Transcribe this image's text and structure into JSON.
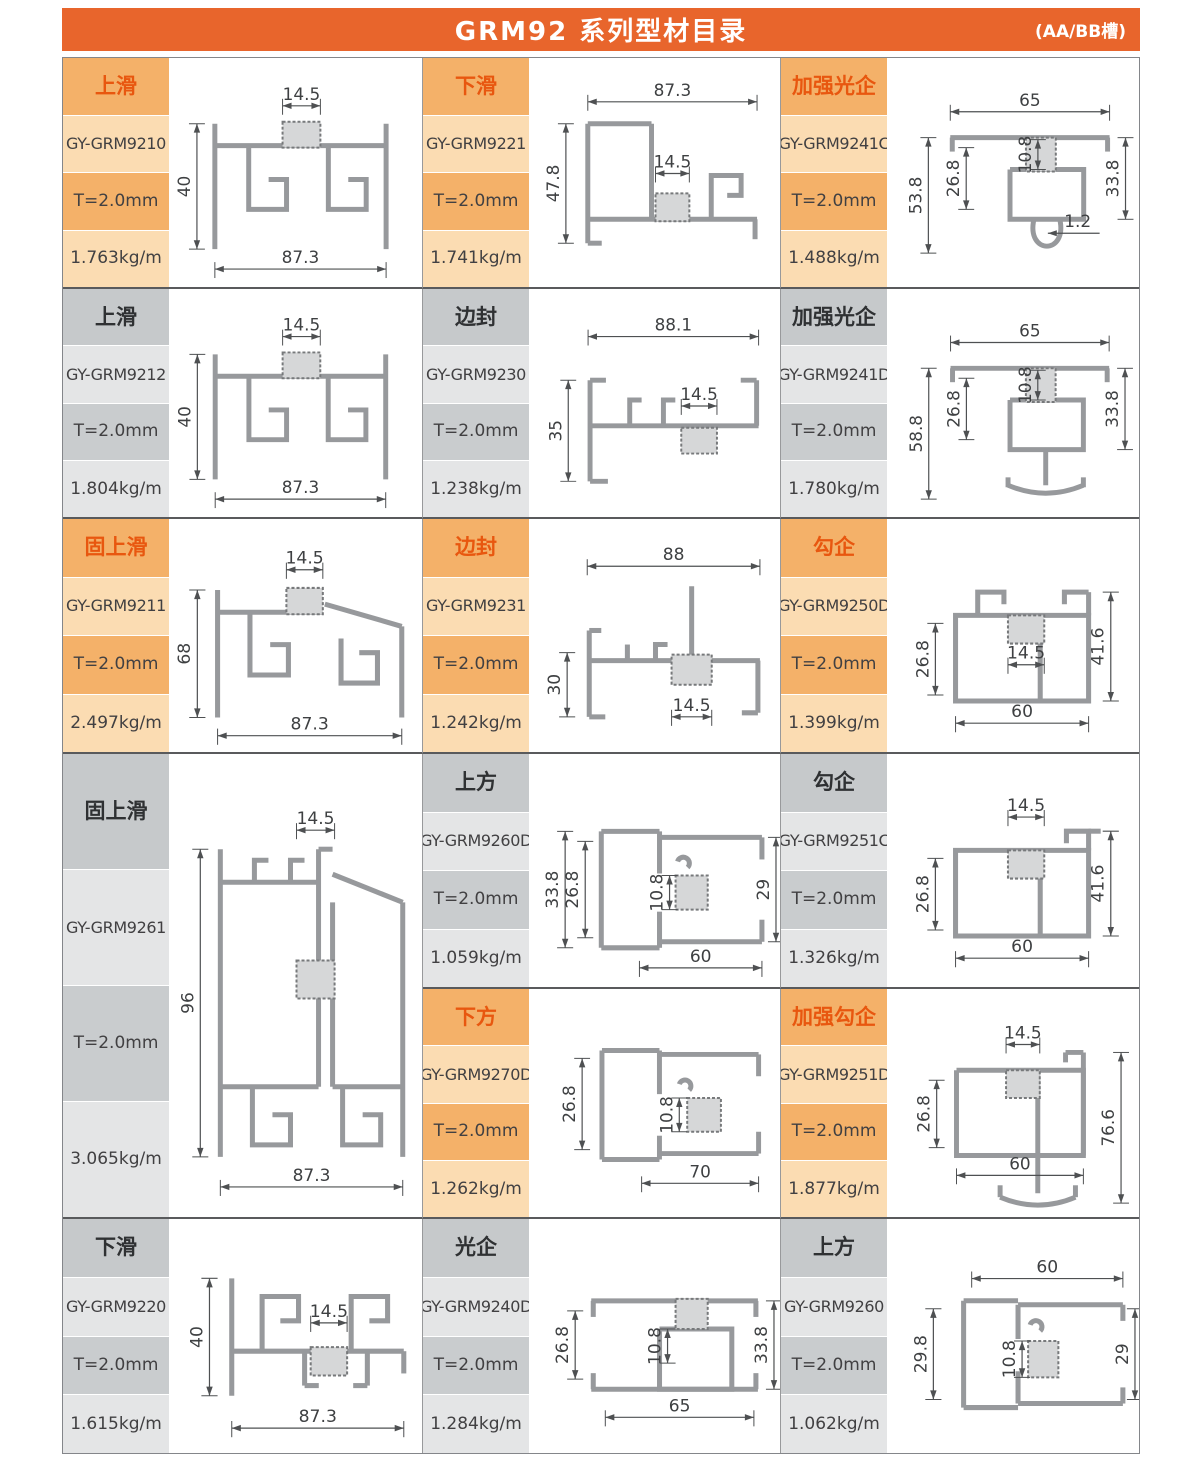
{
  "header": {
    "title": "GRM92 系列型材目录",
    "note": "(AA/BB槽)"
  },
  "theme": {
    "header_bg": "#E8652C",
    "orange_box": "#F4B169",
    "orange_box_light": "#FBDCB2",
    "orange_text": "#E8570F",
    "gray_box": "#C6C9CB",
    "gray_box_light": "#E4E5E6",
    "text_dark": "#414042",
    "line_dark": "#595A5C",
    "profile_gray": "#97999C"
  },
  "cells": [
    {
      "type_label": "上滑",
      "model": "GY-GRM9210",
      "thickness": "T=2.0mm",
      "weight": "1.763kg/m",
      "shape": "t_slide",
      "dims": {
        "top": "14.5",
        "left": "40",
        "bottom": "87.3"
      }
    },
    {
      "type_label": "下滑",
      "model": "GY-GRM9221",
      "thickness": "T=2.0mm",
      "weight": "1.741kg/m",
      "shape": "d_slide21",
      "dims": {
        "top": "87.3",
        "left": "47.8",
        "mid": "14.5"
      }
    },
    {
      "type_label": "加强光企",
      "model": "GY-GRM9241C",
      "thickness": "T=2.0mm",
      "weight": "1.488kg/m",
      "shape": "s_guang_c",
      "dims": {
        "top": "65",
        "left": "53.8",
        "inner": "26.8",
        "core": "10.8",
        "right": "33.8",
        "small": "1.2"
      }
    },
    {
      "type_label": "上滑",
      "model": "GY-GRM9212",
      "thickness": "T=2.0mm",
      "weight": "1.804kg/m",
      "shape": "t_slide",
      "dims": {
        "top": "14.5",
        "left": "40",
        "bottom": "87.3"
      }
    },
    {
      "type_label": "边封",
      "model": "GY-GRM9230",
      "thickness": "T=2.0mm",
      "weight": "1.238kg/m",
      "shape": "bianfeng30",
      "dims": {
        "top": "88.1",
        "left": "35",
        "mid": "14.5"
      }
    },
    {
      "type_label": "加强光企",
      "model": "GY-GRM9241D",
      "thickness": "T=2.0mm",
      "weight": "1.780kg/m",
      "shape": "s_guang_d",
      "dims": {
        "top": "65",
        "left": "58.8",
        "inner": "26.8",
        "core": "10.8",
        "right": "33.8"
      }
    },
    {
      "type_label": "固上滑",
      "model": "GY-GRM9211",
      "thickness": "T=2.0mm",
      "weight": "2.497kg/m",
      "shape": "fix_slide",
      "dims": {
        "top": "14.5",
        "left": "68",
        "bottom": "87.3"
      }
    },
    {
      "type_label": "边封",
      "model": "GY-GRM9231",
      "thickness": "T=2.0mm",
      "weight": "1.242kg/m",
      "shape": "bianfeng31",
      "dims": {
        "top": "88",
        "left": "30",
        "mid": "14.5"
      }
    },
    {
      "type_label": "勾企",
      "model": "GY-GRM9250D",
      "thickness": "T=2.0mm",
      "weight": "1.399kg/m",
      "shape": "gouqi_d",
      "dims": {
        "inner": "26.8",
        "mid": "14.5",
        "right": "41.6",
        "bottom": "60"
      }
    },
    {
      "type_label": "固上滑",
      "model": "GY-GRM9261",
      "thickness": "T=2.0mm",
      "weight": "3.065kg/m",
      "shape": "fix_tall",
      "dims": {
        "top": "14.5",
        "left": "96",
        "bottom": "87.3"
      }
    },
    {
      "type_label": "上方",
      "model": "GY-GRM9260D",
      "thickness": "T=2.0mm",
      "weight": "1.059kg/m",
      "shape": "shangfang_d",
      "dims": {
        "left": "33.8",
        "inner": "26.8",
        "core": "10.8",
        "right": "29",
        "bottom": "60"
      }
    },
    {
      "type_label": "勾企",
      "model": "GY-GRM9251C",
      "thickness": "T=2.0mm",
      "weight": "1.326kg/m",
      "shape": "gouqi_c",
      "dims": {
        "top": "14.5",
        "inner": "26.8",
        "right": "41.6",
        "bottom": "60"
      }
    },
    {
      "type_label": "下方",
      "model": "GY-GRM9270D",
      "thickness": "T=2.0mm",
      "weight": "1.262kg/m",
      "shape": "xiafang_d",
      "dims": {
        "inner": "26.8",
        "core": "10.8",
        "bottom": "70"
      }
    },
    {
      "type_label": "加强勾企",
      "model": "GY-GRM9251D",
      "thickness": "T=2.0mm",
      "weight": "1.877kg/m",
      "shape": "s_gouqi",
      "dims": {
        "top": "14.5",
        "inner": "26.8",
        "right": "76.6",
        "bottom": "60"
      }
    },
    {
      "type_label": "下滑",
      "model": "GY-GRM9220",
      "thickness": "T=2.0mm",
      "weight": "1.615kg/m",
      "shape": "d_slide20",
      "dims": {
        "left": "40",
        "mid": "14.5",
        "bottom": "87.3"
      }
    },
    {
      "type_label": "光企",
      "model": "GY-GRM9240D",
      "thickness": "T=2.0mm",
      "weight": "1.284kg/m",
      "shape": "guangqi",
      "dims": {
        "inner": "26.8",
        "core": "10.8",
        "right": "33.8",
        "bottom": "65"
      }
    },
    {
      "type_label": "上方",
      "model": "GY-GRM9260",
      "thickness": "T=2.0mm",
      "weight": "1.062kg/m",
      "shape": "shangfang",
      "dims": {
        "top": "60",
        "left": "29.8",
        "core": "10.8",
        "right": "29"
      }
    }
  ]
}
